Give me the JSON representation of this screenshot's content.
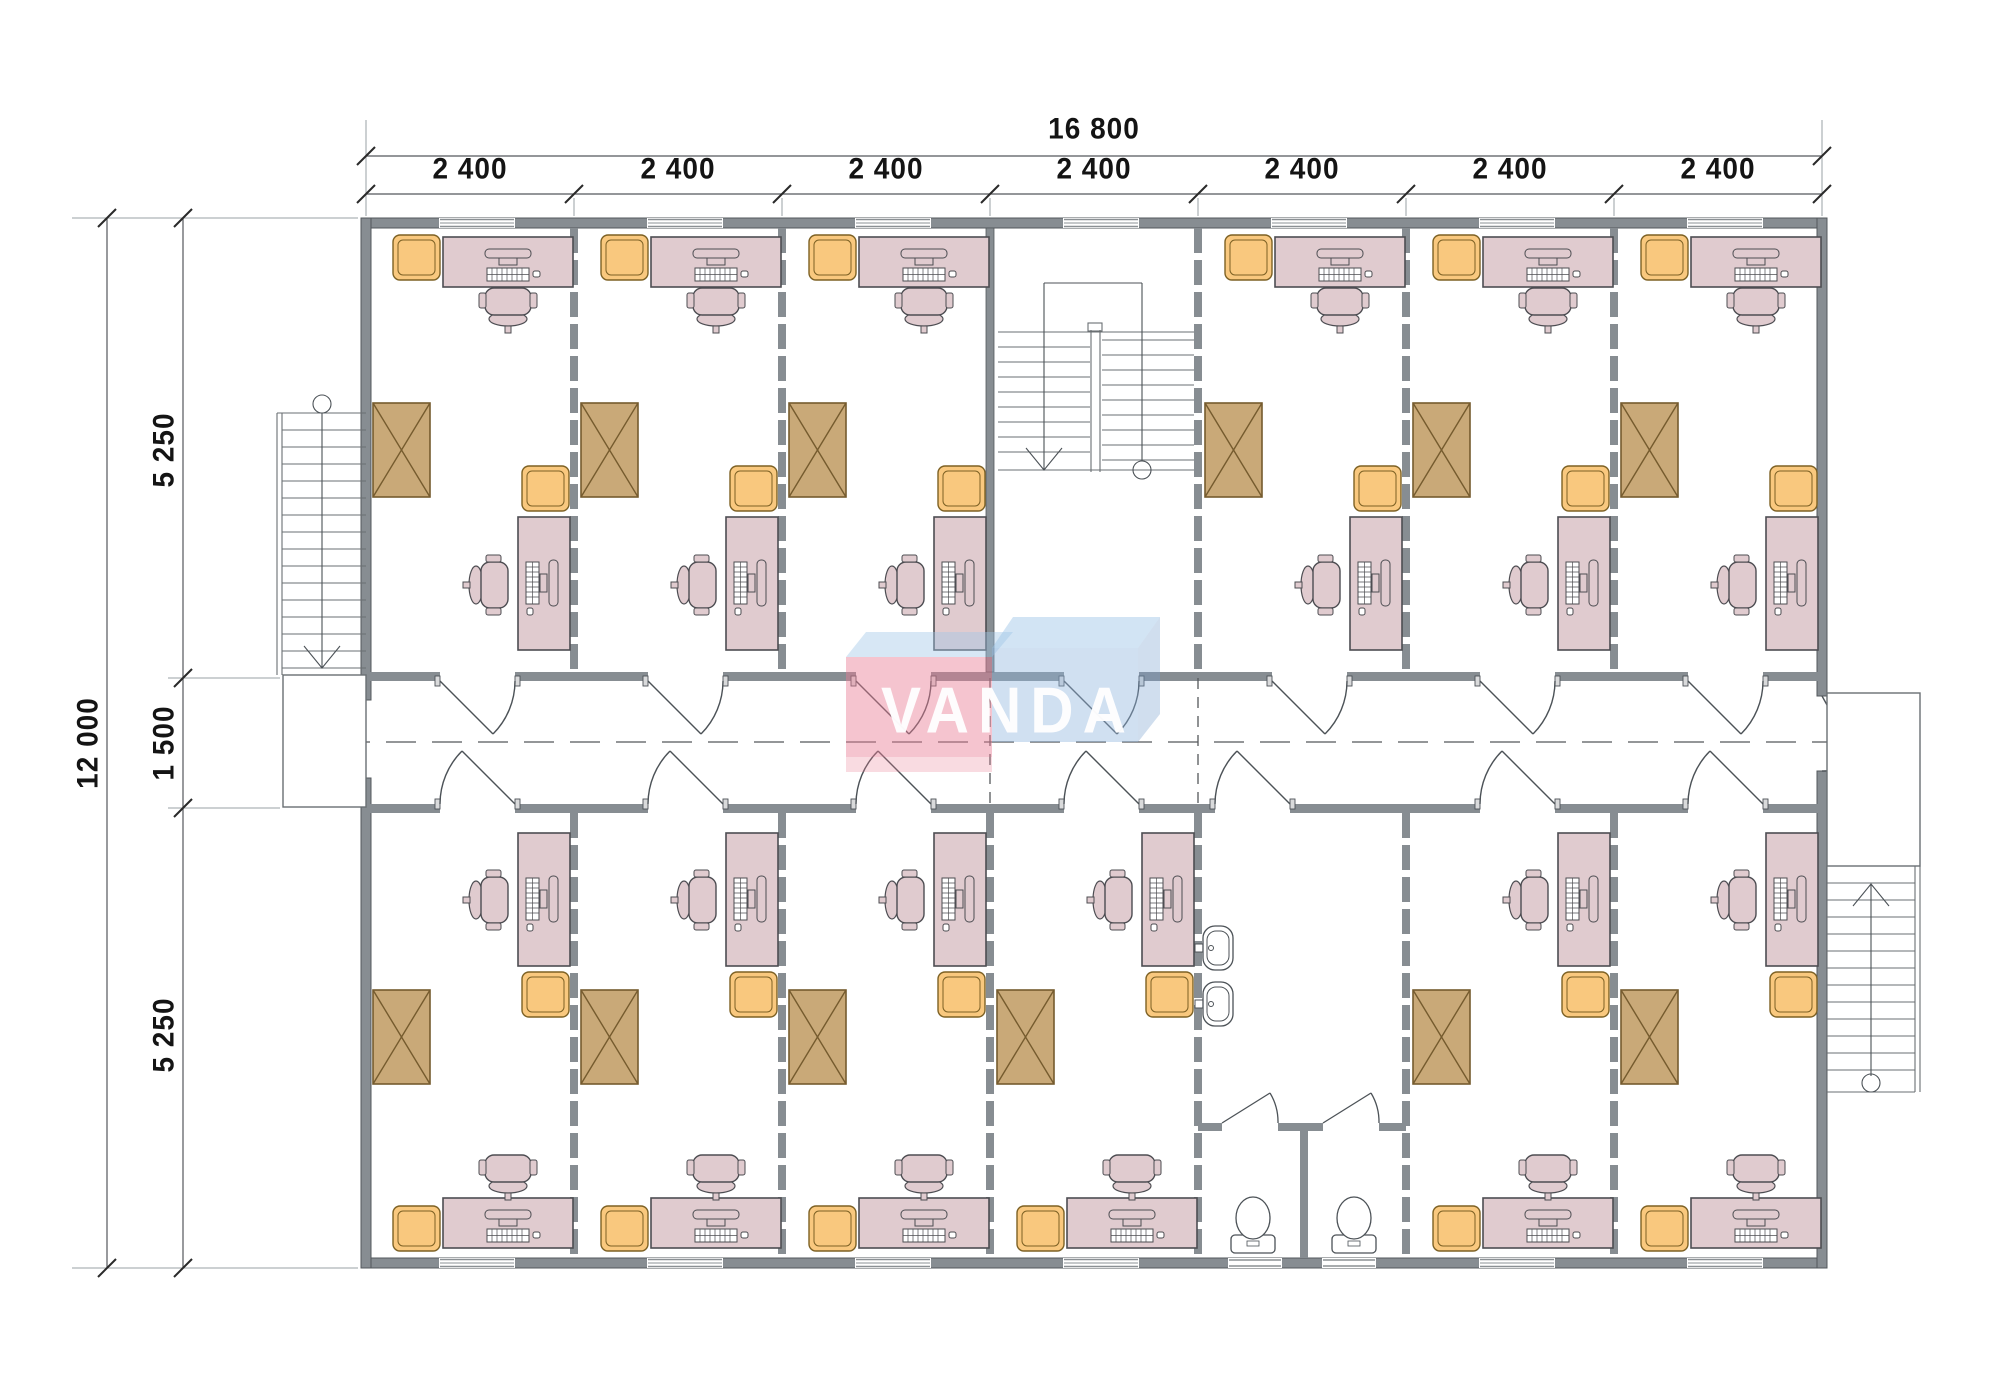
{
  "watermark": {
    "brand": "VANDA"
  },
  "dimensions": {
    "overall_width": "16 800",
    "bay_widths": [
      "2 400",
      "2 400",
      "2 400",
      "2 400",
      "2 400",
      "2 400",
      "2 400"
    ],
    "overall_height": "12 000",
    "height_segments": [
      "5 250",
      "1 500",
      "5 250"
    ]
  },
  "colors": {
    "wall_fill": "#878d92",
    "wall_edge": "#53585c",
    "desk_fill": "#e0cbcf",
    "cabinet_fill": "#f9c87e",
    "wardrobe_fill": "#c9a978",
    "watermark_pink": "rgba(232,125,148,0.45)",
    "watermark_blue": "rgba(142,181,221,0.42)",
    "line": "#4c5257"
  }
}
